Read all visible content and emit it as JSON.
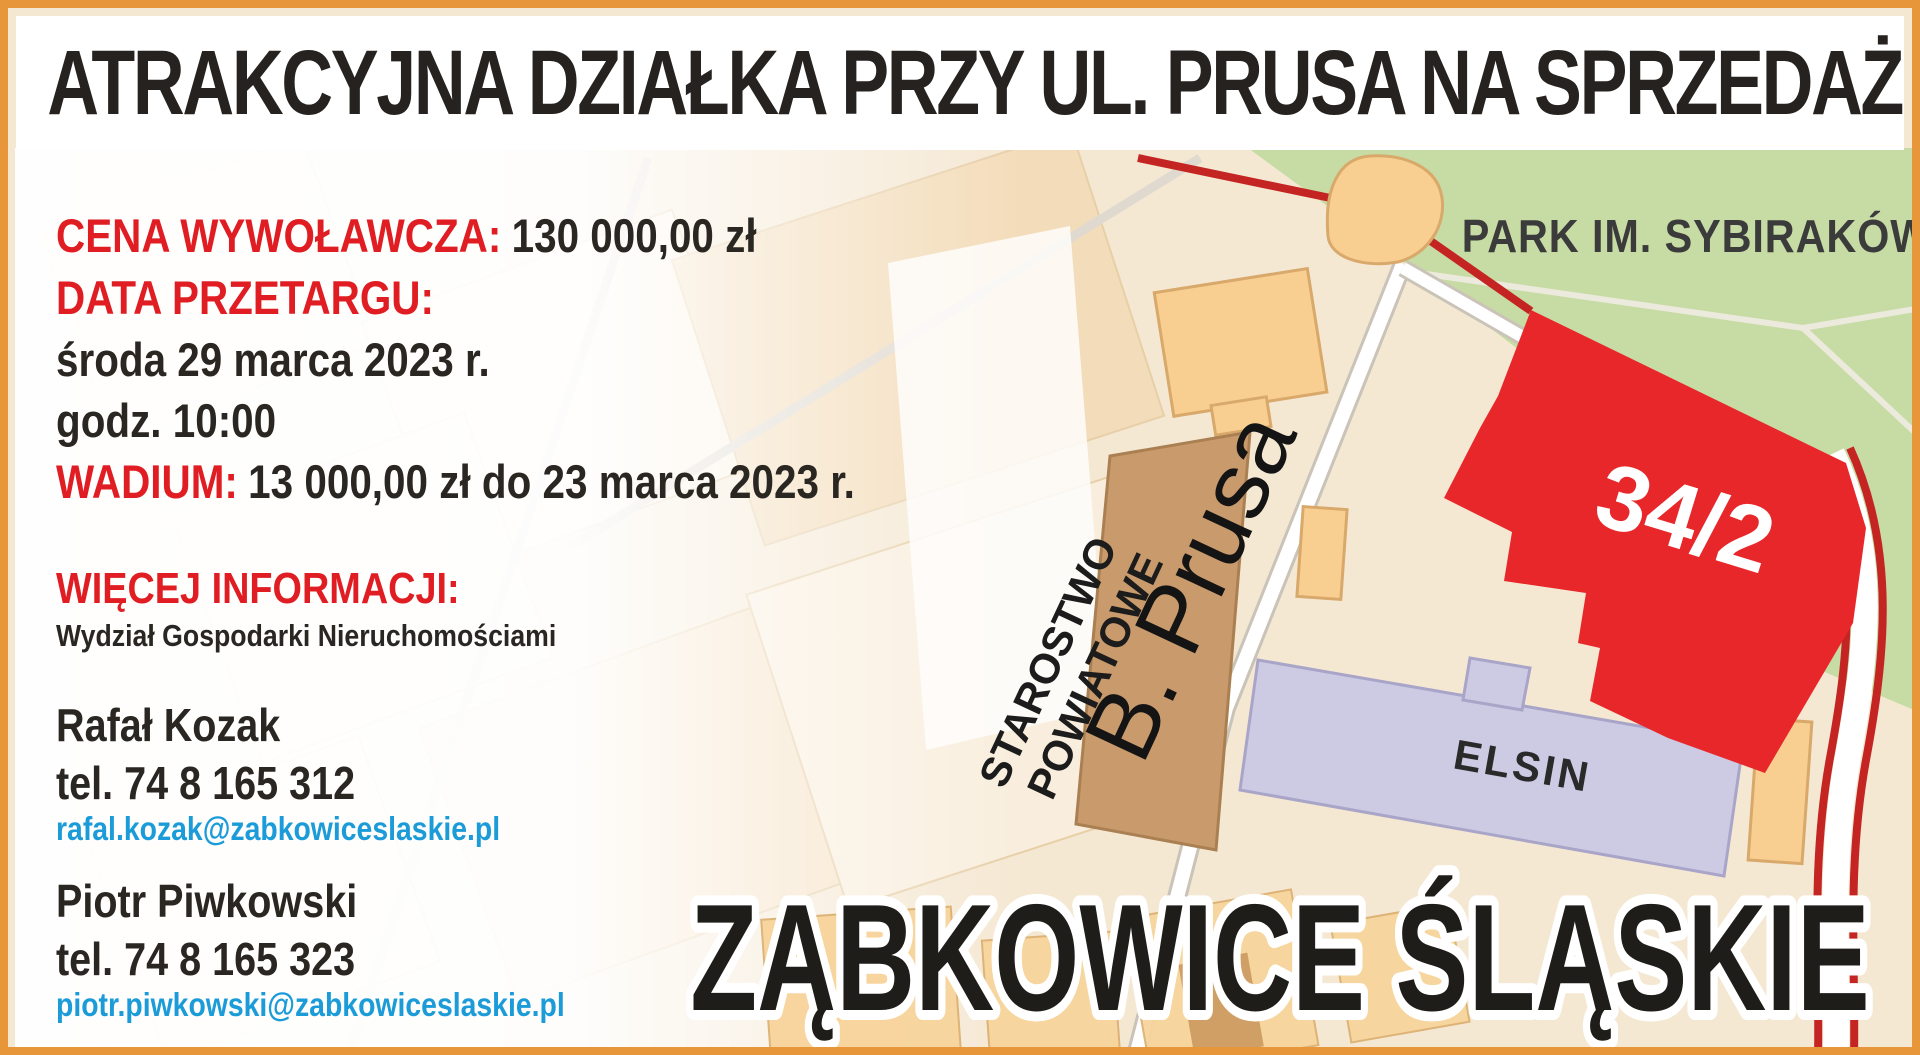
{
  "poster": {
    "border_color": "#e8963a",
    "title": "ATRAKCYJNA DZIAŁKA PRZY UL. PRUSA NA SPRZEDAŻ",
    "details": {
      "price_label": "CENA WYWOŁAWCZA:",
      "price_value": "130 000,00 zł",
      "auction_date_label": "DATA PRZETARGU:",
      "auction_date": "środa 29 marca 2023 r.",
      "auction_time": "godz. 10:00",
      "deposit_label": "WADIUM:",
      "deposit_value": "13 000,00 zł do 23 marca 2023 r."
    },
    "more_info": {
      "label": "WIĘCEJ INFORMACJI:",
      "department": "Wydział Gospodarki Nieruchomościami",
      "contacts": [
        {
          "name": "Rafał Kozak",
          "phone": "tel. 74 8 165 312",
          "email": "rafal.kozak@zabkowiceslaskie.pl"
        },
        {
          "name": "Piotr Piwkowski",
          "phone": "tel. 74 8 165 323",
          "email": "piotr.piwkowski@zabkowiceslaskie.pl"
        }
      ]
    },
    "map": {
      "park_label": "PARK IM. SYBIRAKÓW",
      "parcel_number": "34/2",
      "office_label_line1": "STAROSTWO",
      "office_label_line2": "POWIATOWE",
      "street_label": "B. Prusa",
      "company_label": "ELSIN",
      "city_label": "ZĄBKOWICE ŚLĄSKIE",
      "parcel_color": "#e8272b",
      "park_color": "#c7dba4"
    },
    "colors": {
      "accent_red": "#e01d23",
      "link_blue": "#1b9cd9"
    }
  }
}
